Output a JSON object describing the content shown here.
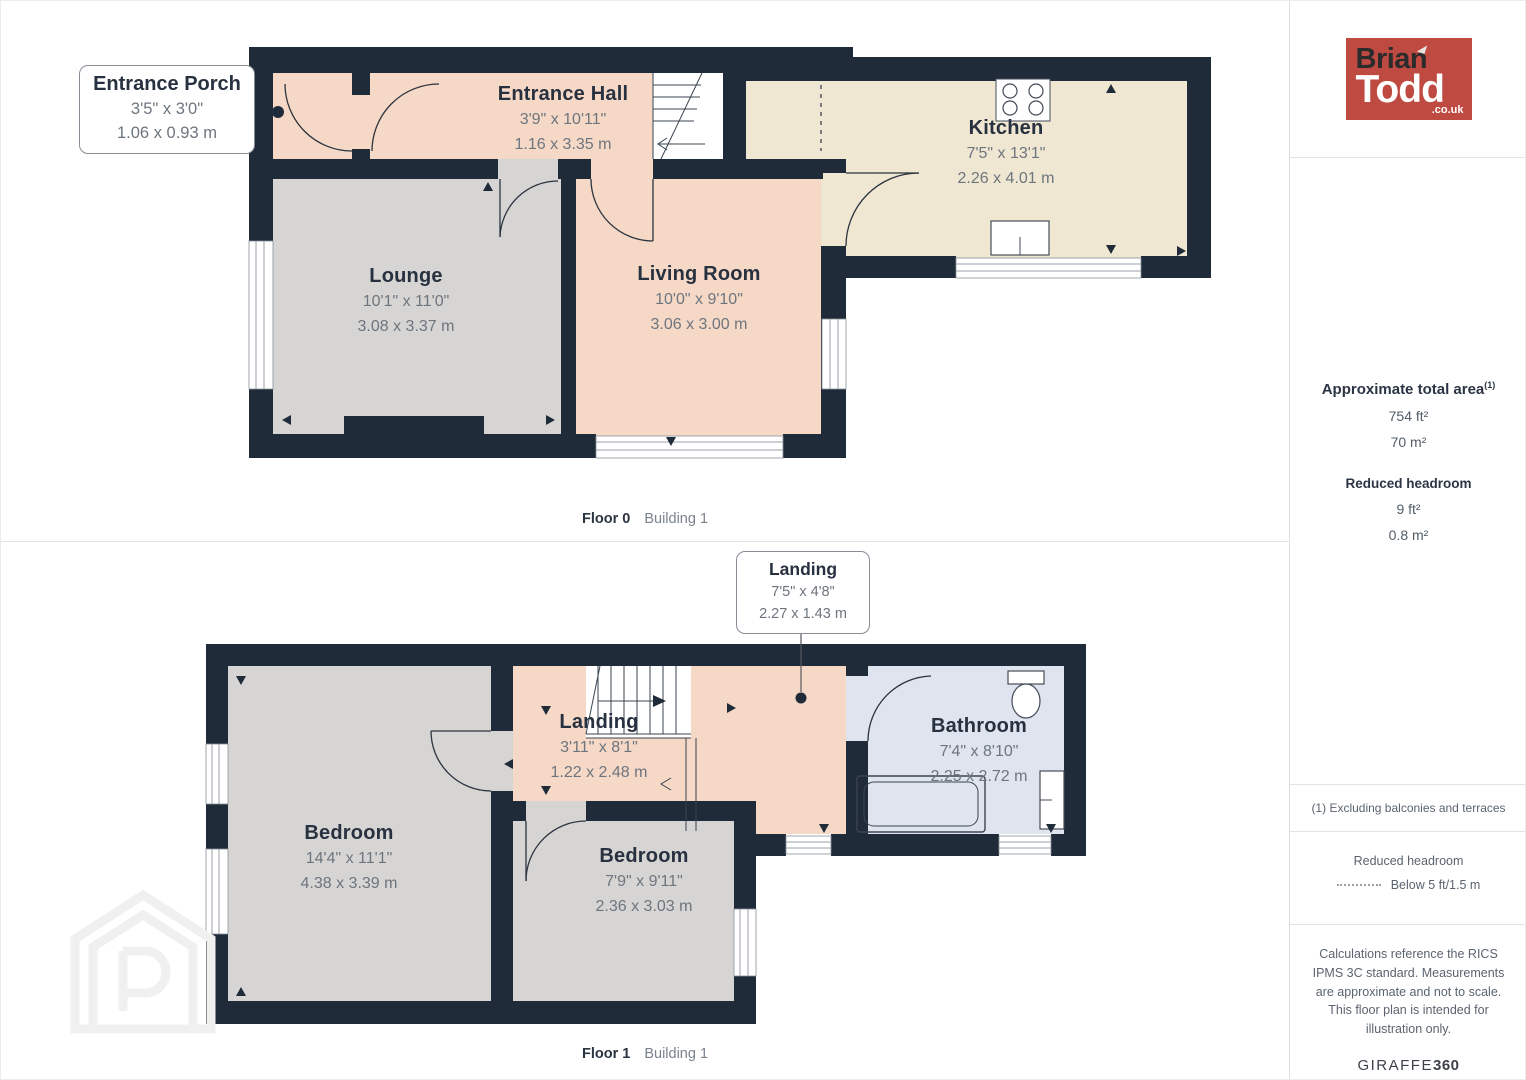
{
  "colors": {
    "wall": "#202b3a",
    "room_salmon": "#f5d8c6",
    "room_gray": "#d6d5d4",
    "room_cream": "#efe7d1",
    "room_blue": "#dfe4ef",
    "logo_red": "#bf4a41"
  },
  "floor0": {
    "caption_floor": "Floor 0",
    "caption_building": "Building 1",
    "rooms": {
      "entrance_porch": {
        "name": "Entrance Porch",
        "dims_ft": "3'5\" x 3'0\"",
        "dims_m": "1.06 x 0.93 m"
      },
      "entrance_hall": {
        "name": "Entrance Hall",
        "dims_ft": "3'9\" x 10'11\"",
        "dims_m": "1.16 x 3.35 m"
      },
      "kitchen": {
        "name": "Kitchen",
        "dims_ft": "7'5\" x 13'1\"",
        "dims_m": "2.26 x 4.01 m"
      },
      "lounge": {
        "name": "Lounge",
        "dims_ft": "10'1\" x 11'0\"",
        "dims_m": "3.08 x 3.37 m"
      },
      "living_room": {
        "name": "Living Room",
        "dims_ft": "10'0\" x 9'10\"",
        "dims_m": "3.06 x 3.00 m"
      }
    }
  },
  "floor1": {
    "caption_floor": "Floor 1",
    "caption_building": "Building 1",
    "rooms": {
      "landing_callout": {
        "name": "Landing",
        "dims_ft": "7'5\" x 4'8\"",
        "dims_m": "2.27 x 1.43 m"
      },
      "landing": {
        "name": "Landing",
        "dims_ft": "3'11\" x 8'1\"",
        "dims_m": "1.22 x 2.48 m"
      },
      "bathroom": {
        "name": "Bathroom",
        "dims_ft": "7'4\" x 8'10\"",
        "dims_m": "2.25 x 2.72 m"
      },
      "bedroom_large": {
        "name": "Bedroom",
        "dims_ft": "14'4\" x 11'1\"",
        "dims_m": "4.38 x 3.39 m"
      },
      "bedroom_small": {
        "name": "Bedroom",
        "dims_ft": "7'9\" x 9'11\"",
        "dims_m": "2.36 x 3.03 m"
      }
    }
  },
  "sidebar": {
    "logo": {
      "line1": "Brian",
      "line2": "Todd",
      "suffix": ".co.uk"
    },
    "area": {
      "title": "Approximate total area",
      "title_sup": "(1)",
      "value_ft": "754 ft²",
      "value_m": "70 m²",
      "headroom_title": "Reduced headroom",
      "headroom_ft": "9 ft²",
      "headroom_m": "0.8 m²"
    },
    "footnote": "(1) Excluding balconies and terraces",
    "legend": {
      "title": "Reduced headroom",
      "label": "Below 5 ft/1.5 m"
    },
    "disclaimer": "Calculations reference the RICS IPMS 3C standard. Measurements are approximate and not to scale. This floor plan is intended for illustration only.",
    "brand_name": "GIRAFFE",
    "brand_suffix": "360"
  }
}
